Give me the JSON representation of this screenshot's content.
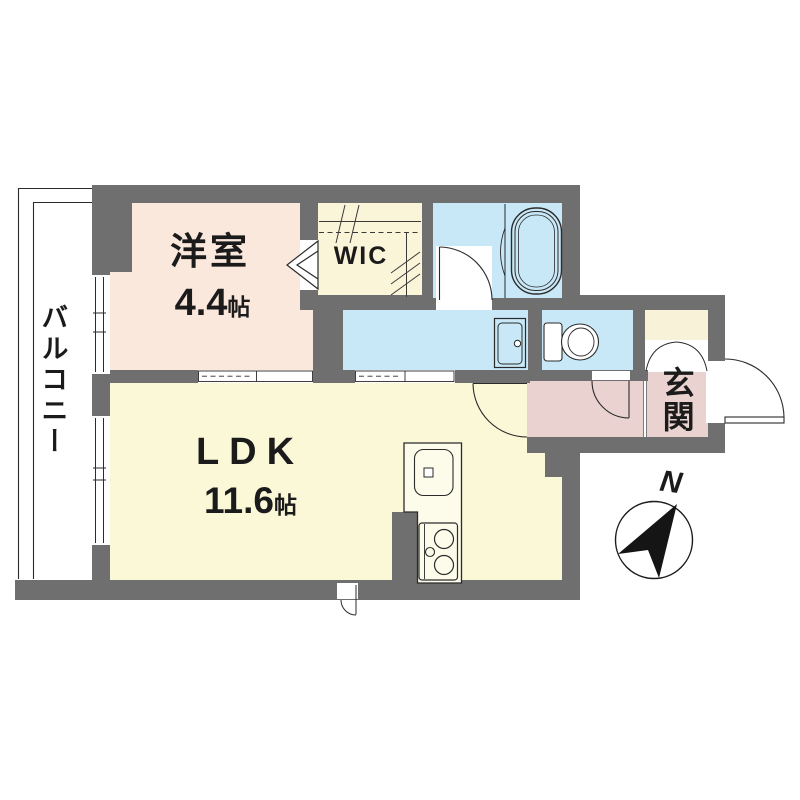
{
  "floorplan": {
    "type": "apartment-floor-plan",
    "rooms": {
      "balcony": {
        "label": "バルコニー"
      },
      "western_room": {
        "label": "洋室",
        "size_value": "4.4",
        "size_unit": "帖"
      },
      "wic": {
        "label": "WIC"
      },
      "ldk": {
        "label": "LDK",
        "size_value": "11.6",
        "size_unit": "帖"
      },
      "genkan": {
        "label": "玄関"
      }
    },
    "compass": {
      "north_label": "N"
    },
    "colors": {
      "wall": "#6f6f6f",
      "western_room": "#fbe8dc",
      "wic": "#faf4d8",
      "ldk": "#fbf8d8",
      "wet_rooms": "#c8e8f7",
      "entrance_hall": "#e9d2cf",
      "shoe_cabinet": "#f8f3d8",
      "line": "#2b2b2b"
    }
  }
}
